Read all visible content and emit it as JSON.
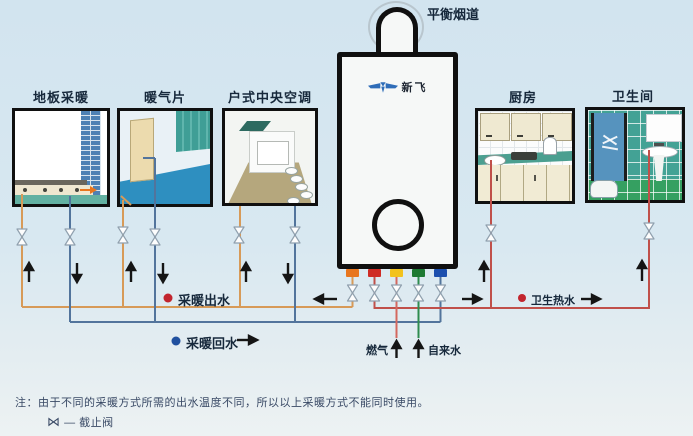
{
  "flue_label": "平衡烟道",
  "brand": "新飞",
  "panels": [
    {
      "title": "地板采暖"
    },
    {
      "title": "暖气片"
    },
    {
      "title": "户式中央空调"
    },
    {
      "title": "厨房"
    },
    {
      "title": "卫生间"
    }
  ],
  "legend": {
    "supply_label": "采暖出水",
    "return_label": "采暖回水",
    "hot_water_label": "卫生热水"
  },
  "inlets": {
    "gas_label": "燃气",
    "tap_water_label": "自来水"
  },
  "note": {
    "line1": "注：由于不同的采暖方式所需的出水温度不同，所以以上采暖方式不能同时使用。",
    "valve_symbol": "⋈",
    "valve_dash": "—",
    "valve_label": "截止阀"
  },
  "colors": {
    "background": "#d8e8f1",
    "supply_pipe": "#d79a58",
    "return_pipe": "#52749c",
    "hot_water_pipe": "#c0504a",
    "gas_pipe": "#d4685f",
    "tap_water_pipe": "#2f8c4f",
    "stub_orange": "#e8761e",
    "stub_red": "#cf2b24",
    "stub_yellow": "#f2c21c",
    "stub_green": "#1d7a33",
    "stub_blue": "#1c4fae",
    "legend_red_dot": "#c2252e",
    "legend_blue_dot": "#20509f"
  }
}
